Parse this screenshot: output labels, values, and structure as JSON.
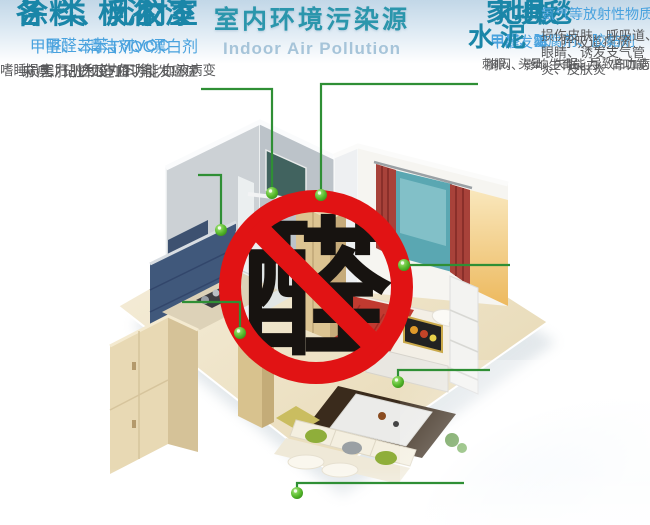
{
  "title": {
    "main": "室内环境污染源",
    "subtitle": "Indoor Air Pollution"
  },
  "center_badge": {
    "character": "醛",
    "symbol": "no-formaldehyde-prohibition-sign"
  },
  "sources": {
    "bathroom": {
      "heading": "浴室",
      "pollutants": "清洁剂、漂白剂",
      "effects": "麻痹、记忆力下降、引发癌症"
    },
    "paint": {
      "heading": "涂料、乳胶漆",
      "pollutants": "甲醛、苯、TVOC",
      "effects": "嗜睡、无力、免疫力下降、血液病变"
    },
    "boards": {
      "heading": "各类板材",
      "pollutants": "甲醛、苯、TVOC",
      "effects": "损害肝脏和造血功能"
    },
    "furniture": {
      "heading": "家具",
      "pollutants": "甲醛、苯",
      "effects": "刺眼、头晕、失眠、导致白血病"
    },
    "carpet": {
      "heading": "地毯",
      "pollutants": "发霉",
      "effects": "呼吸道疾病"
    },
    "floor": {
      "heading": "地板",
      "pollutants": "甲醛、防腐剂、胶黏剂",
      "effects": "胸闷、影响生育能力、肾功能"
    },
    "cement": {
      "heading": "水泥",
      "pollutants": "氨气等放射性物质",
      "effects": "损伤皮肤、呼吸道、眼睛、诱发支气管炎、皮肤炎"
    }
  },
  "colors": {
    "heading_teal": "#1a86a8",
    "pollutant_blue": "#49a2de",
    "effect_gray": "#58595b",
    "leader_green": "#2f8f35",
    "prohibition_red": "#e11314",
    "title_teal": "#2b96ac",
    "subtitle_blue": "#a6c4d9"
  }
}
